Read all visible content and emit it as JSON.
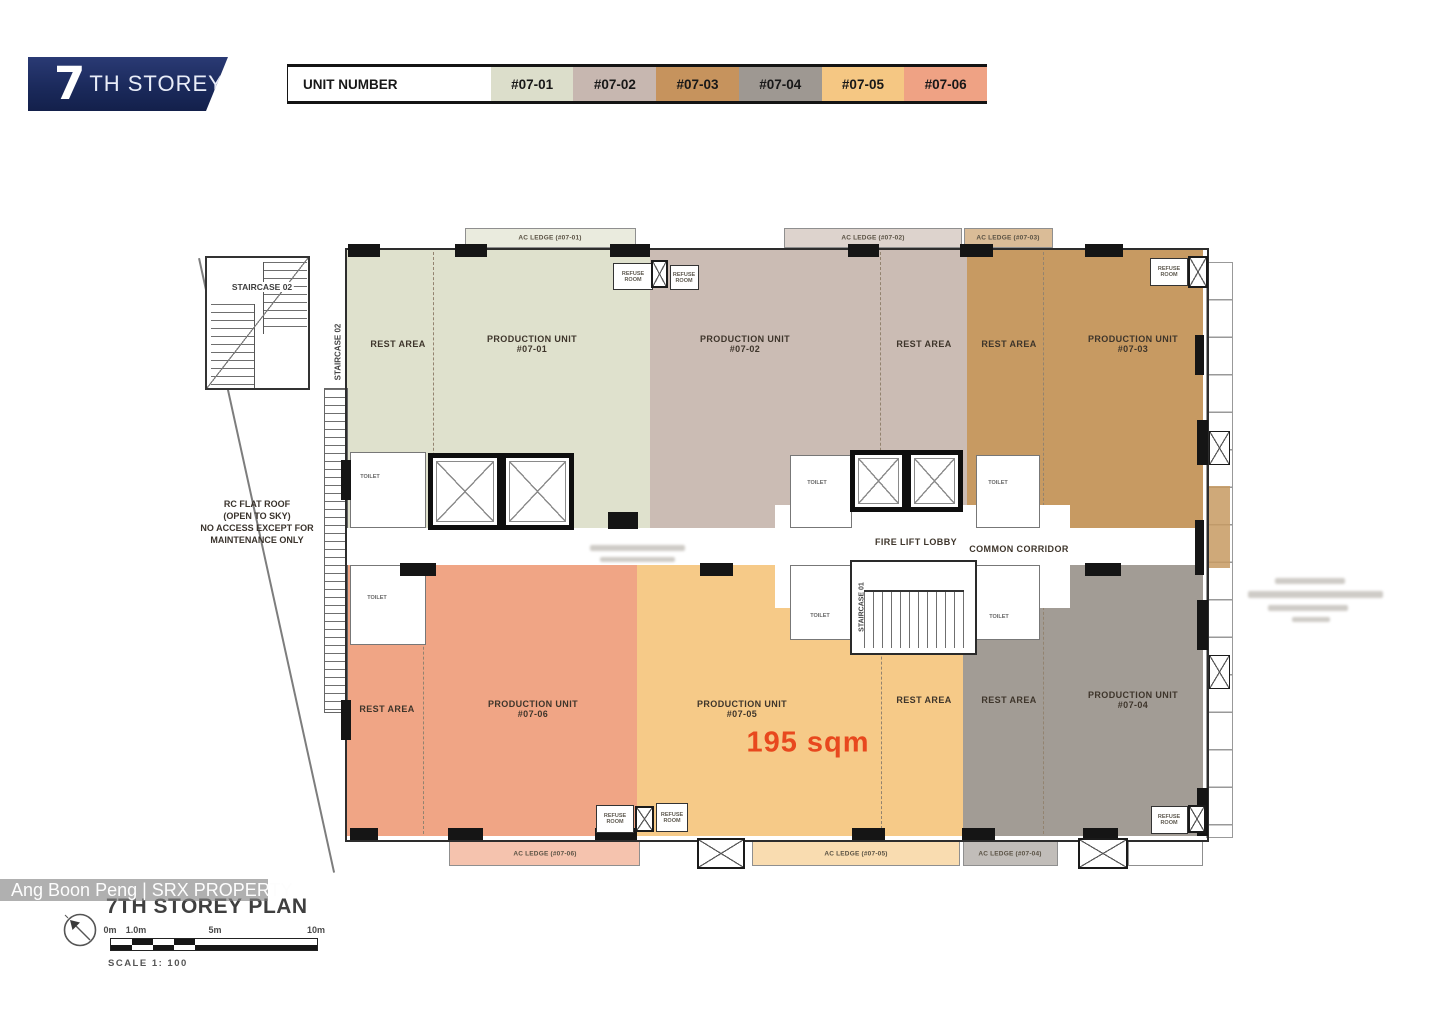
{
  "banner": {
    "number": "7",
    "suffix": "TH STOREY"
  },
  "legend": {
    "title": "UNIT NUMBER",
    "units": [
      {
        "label": "#07-01",
        "color": "#dcdecb"
      },
      {
        "label": "#07-02",
        "color": "#c7b7b0"
      },
      {
        "label": "#07-03",
        "color": "#c6935d"
      },
      {
        "label": "#07-04",
        "color": "#9e9892"
      },
      {
        "label": "#07-05",
        "color": "#f5c783"
      },
      {
        "label": "#07-06",
        "color": "#efa284"
      }
    ]
  },
  "plan": {
    "annex_staircase": "STAIRCASE 02",
    "inner_staircase": "STAIRCASE 02",
    "core_staircase": "STAIRCASE 01",
    "roof_note": [
      "RC FLAT ROOF",
      "(OPEN TO SKY)",
      "NO ACCESS EXCEPT FOR",
      "MAINTENANCE ONLY"
    ],
    "fire_lift_lobby": "FIRE LIFT LOBBY",
    "common_corridor": "COMMON CORRIDOR",
    "toilet": "TOILET",
    "refuse": "REFUSE ROOM",
    "units": [
      {
        "unit_no": "#07-01",
        "prod": "PRODUCTION UNIT",
        "rest": "REST AREA",
        "color": "#dfe1cd"
      },
      {
        "unit_no": "#07-02",
        "prod": "PRODUCTION UNIT",
        "rest": "REST AREA",
        "color": "#cbbcb4"
      },
      {
        "unit_no": "#07-03",
        "prod": "PRODUCTION UNIT",
        "rest": "REST AREA",
        "color": "#c79a62"
      },
      {
        "unit_no": "#07-04",
        "prod": "PRODUCTION UNIT",
        "rest": "REST AREA",
        "color": "#a29c95"
      },
      {
        "unit_no": "#07-05",
        "prod": "PRODUCTION UNIT",
        "rest": "REST AREA",
        "color": "#f6ca88",
        "area": "195 sqm"
      },
      {
        "unit_no": "#07-06",
        "prod": "PRODUCTION UNIT",
        "rest": "REST AREA",
        "color": "#f0a585"
      }
    ],
    "area_highlight_color": "#e8481e",
    "ac_ledges": {
      "top": [
        "AC LEDGE (#07-01)",
        "AC LEDGE (#07-02)",
        "AC LEDGE (#07-03)"
      ],
      "bottom": [
        "AC LEDGE (#07-06)",
        "AC LEDGE (#07-05)",
        "AC LEDGE (#07-04)"
      ]
    }
  },
  "footer": {
    "watermark": "Ang Boon Peng | SRX PROPERTY",
    "plan_title": "7TH STOREY PLAN",
    "scale_ticks": [
      "0m",
      "1.0m",
      "5m",
      "10m"
    ],
    "scale_text": "SCALE 1: 100"
  }
}
